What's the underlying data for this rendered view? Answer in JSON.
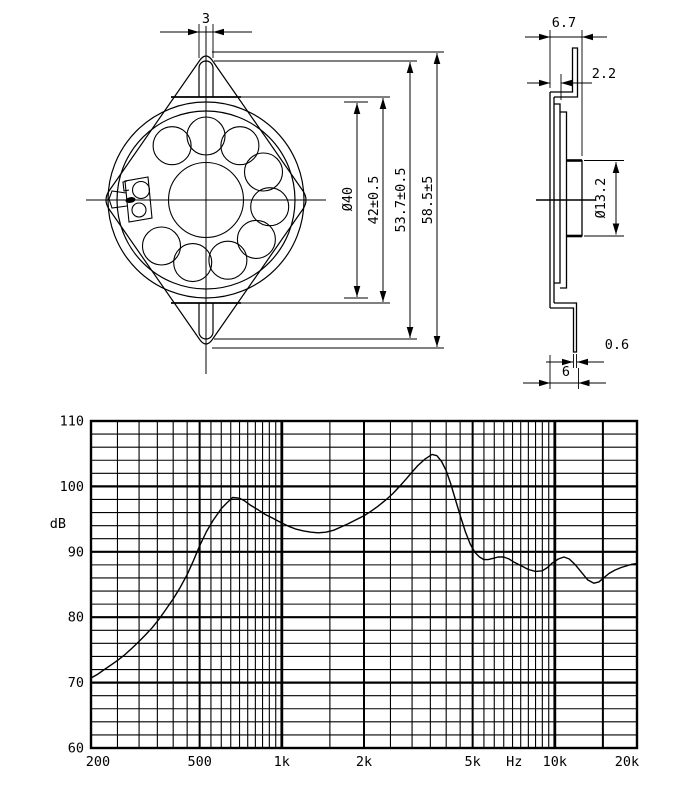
{
  "colors": {
    "ink": "#000000",
    "paper": "#ffffff"
  },
  "drawing": {
    "front_view": {
      "dims": {
        "slot_width": "3",
        "cone_diameter": "Ø40",
        "frame_width": "42±0.5",
        "slot_span": "53.7±0.5",
        "overall_height": "58.5±5"
      }
    },
    "side_view": {
      "dims": {
        "depth": "6.7",
        "flange_offset": "2.2",
        "magnet_diameter": "Ø13.2",
        "tab_thickness": "0.6",
        "tab_width": "6"
      }
    }
  },
  "chart_data": {
    "type": "line",
    "xlabel": "Hz",
    "ylabel": "dB",
    "x_scale": "log",
    "xlim": [
      200,
      20000
    ],
    "ylim": [
      60,
      110
    ],
    "grid_on": true,
    "x_ticks": [
      {
        "f": 200,
        "label": "200"
      },
      {
        "f": 500,
        "label": "500"
      },
      {
        "f": 1000,
        "label": "1k"
      },
      {
        "f": 2000,
        "label": "2k"
      },
      {
        "f": 5000,
        "label": "5k"
      },
      {
        "f": 7100,
        "label": "Hz"
      },
      {
        "f": 10000,
        "label": "10k"
      },
      {
        "f": 20000,
        "label": "20k"
      }
    ],
    "y_ticks": [
      {
        "v": 110,
        "label": "110"
      },
      {
        "v": 100,
        "label": "100"
      },
      {
        "v": 90,
        "label": "90"
      },
      {
        "v": 80,
        "label": "80"
      },
      {
        "v": 70,
        "label": "70"
      },
      {
        "v": 60,
        "label": "60"
      }
    ],
    "grid": {
      "x_minor": [
        250,
        300,
        350,
        400,
        450,
        550,
        600,
        650,
        700,
        750,
        800,
        850,
        900,
        950,
        1500,
        2500,
        3000,
        3500,
        4000,
        4500,
        5500,
        6000,
        6500,
        7000,
        7500,
        8000,
        8500,
        9000,
        9500
      ],
      "x_major": [
        500,
        2000,
        5000,
        15000
      ],
      "x_strong": [
        1000,
        10000
      ],
      "y_minor_step": 2,
      "y_major": [
        70,
        80,
        90,
        100
      ]
    },
    "series": [
      {
        "points": [
          [
            200,
            70.7
          ],
          [
            212,
            71.3
          ],
          [
            224,
            72.0
          ],
          [
            237,
            72.7
          ],
          [
            250,
            73.4
          ],
          [
            265,
            74.2
          ],
          [
            280,
            75.1
          ],
          [
            300,
            76.3
          ],
          [
            315,
            77.2
          ],
          [
            335,
            78.4
          ],
          [
            355,
            79.7
          ],
          [
            375,
            81.1
          ],
          [
            400,
            82.8
          ],
          [
            425,
            84.6
          ],
          [
            450,
            86.5
          ],
          [
            475,
            88.7
          ],
          [
            500,
            90.9
          ],
          [
            530,
            93.1
          ],
          [
            560,
            94.8
          ],
          [
            600,
            96.6
          ],
          [
            630,
            97.5
          ],
          [
            660,
            98.3
          ],
          [
            700,
            98.2
          ],
          [
            730,
            97.8
          ],
          [
            770,
            97.1
          ],
          [
            820,
            96.4
          ],
          [
            870,
            95.7
          ],
          [
            920,
            95.2
          ],
          [
            1000,
            94.4
          ],
          [
            1060,
            93.9
          ],
          [
            1120,
            93.5
          ],
          [
            1200,
            93.2
          ],
          [
            1280,
            93.0
          ],
          [
            1360,
            92.9
          ],
          [
            1450,
            93.0
          ],
          [
            1550,
            93.3
          ],
          [
            1650,
            93.8
          ],
          [
            1750,
            94.3
          ],
          [
            1850,
            94.8
          ],
          [
            2000,
            95.5
          ],
          [
            2120,
            96.2
          ],
          [
            2240,
            96.9
          ],
          [
            2400,
            97.9
          ],
          [
            2550,
            98.9
          ],
          [
            2700,
            100.0
          ],
          [
            2850,
            101.1
          ],
          [
            3000,
            102.2
          ],
          [
            3150,
            103.2
          ],
          [
            3350,
            104.2
          ],
          [
            3550,
            104.9
          ],
          [
            3700,
            104.7
          ],
          [
            3850,
            103.8
          ],
          [
            4000,
            102.4
          ],
          [
            4150,
            100.5
          ],
          [
            4300,
            98.3
          ],
          [
            4500,
            95.6
          ],
          [
            4700,
            93.1
          ],
          [
            4900,
            91.2
          ],
          [
            5100,
            89.9
          ],
          [
            5300,
            89.2
          ],
          [
            5500,
            88.8
          ],
          [
            5700,
            88.8
          ],
          [
            5950,
            89.0
          ],
          [
            6200,
            89.2
          ],
          [
            6500,
            89.2
          ],
          [
            6800,
            88.9
          ],
          [
            7100,
            88.4
          ],
          [
            7500,
            87.9
          ],
          [
            8000,
            87.3
          ],
          [
            8500,
            87.0
          ],
          [
            9000,
            87.1
          ],
          [
            9400,
            87.6
          ],
          [
            9800,
            88.3
          ],
          [
            10300,
            88.9
          ],
          [
            10800,
            89.2
          ],
          [
            11300,
            88.9
          ],
          [
            11900,
            88.0
          ],
          [
            12500,
            86.9
          ],
          [
            13200,
            85.7
          ],
          [
            13900,
            85.2
          ],
          [
            14500,
            85.4
          ],
          [
            15000,
            85.9
          ],
          [
            15800,
            86.7
          ],
          [
            16600,
            87.2
          ],
          [
            17500,
            87.6
          ],
          [
            18500,
            87.9
          ],
          [
            19200,
            88.1
          ],
          [
            20000,
            88.2
          ]
        ]
      }
    ]
  }
}
